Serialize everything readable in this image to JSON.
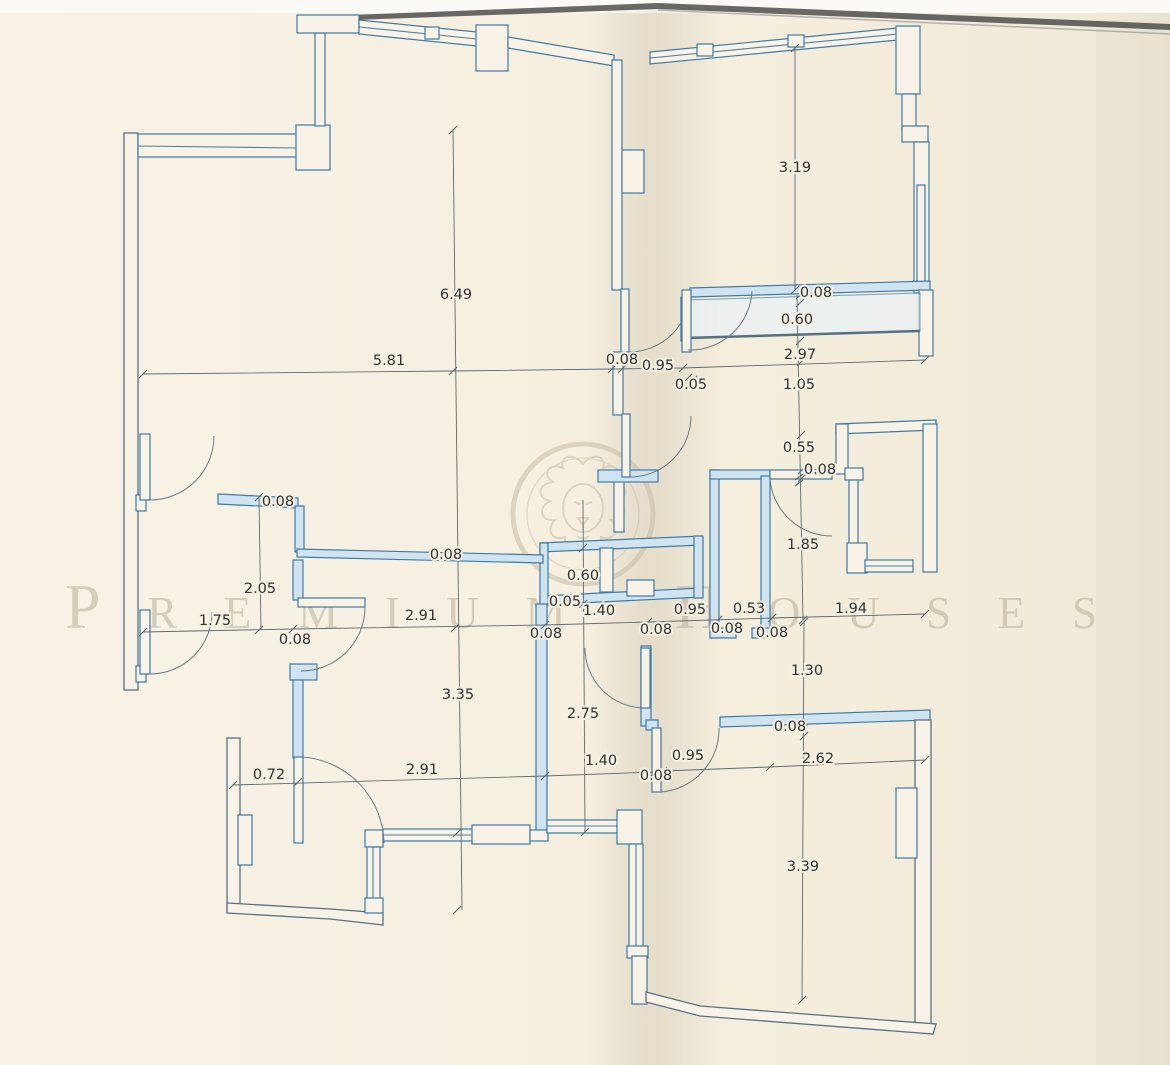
{
  "watermark": {
    "brand": "Premium Houses"
  },
  "plan": {
    "dimensions": [
      {
        "value": "3.19",
        "x": 795,
        "y": 172
      },
      {
        "value": "0.08",
        "x": 816,
        "y": 297
      },
      {
        "value": "0.60",
        "x": 797,
        "y": 324
      },
      {
        "value": "2.97",
        "x": 800,
        "y": 359
      },
      {
        "value": "0.08",
        "x": 622,
        "y": 364
      },
      {
        "value": "0.95",
        "x": 658,
        "y": 370
      },
      {
        "value": "0.05",
        "x": 691,
        "y": 389
      },
      {
        "value": "1.05",
        "x": 799,
        "y": 389
      },
      {
        "value": "0.55",
        "x": 799,
        "y": 452
      },
      {
        "value": "0.08",
        "x": 820,
        "y": 474
      },
      {
        "value": "1.85",
        "x": 803,
        "y": 549
      },
      {
        "value": "6.49",
        "x": 456,
        "y": 299
      },
      {
        "value": "5.81",
        "x": 389,
        "y": 365
      },
      {
        "value": "0.08",
        "x": 278,
        "y": 506
      },
      {
        "value": "0.08",
        "x": 446,
        "y": 559
      },
      {
        "value": "0.60",
        "x": 583,
        "y": 580
      },
      {
        "value": "0.05",
        "x": 565,
        "y": 606
      },
      {
        "value": "2.05",
        "x": 260,
        "y": 593
      },
      {
        "value": "1.75",
        "x": 215,
        "y": 625
      },
      {
        "value": "2.91",
        "x": 421,
        "y": 620
      },
      {
        "value": "1.40",
        "x": 599,
        "y": 615
      },
      {
        "value": "0.95",
        "x": 690,
        "y": 614
      },
      {
        "value": "0.53",
        "x": 749,
        "y": 613
      },
      {
        "value": "1.94",
        "x": 851,
        "y": 613
      },
      {
        "value": "0.08",
        "x": 295,
        "y": 644
      },
      {
        "value": "0.08",
        "x": 546,
        "y": 638
      },
      {
        "value": "0.08",
        "x": 656,
        "y": 634
      },
      {
        "value": "0.08",
        "x": 727,
        "y": 633
      },
      {
        "value": "0.08",
        "x": 772,
        "y": 637
      },
      {
        "value": "1.30",
        "x": 807,
        "y": 675
      },
      {
        "value": "3.35",
        "x": 458,
        "y": 699
      },
      {
        "value": "2.75",
        "x": 583,
        "y": 718
      },
      {
        "value": "0.08",
        "x": 790,
        "y": 731
      },
      {
        "value": "0.72",
        "x": 269,
        "y": 779
      },
      {
        "value": "2.91",
        "x": 422,
        "y": 774
      },
      {
        "value": "1.40",
        "x": 601,
        "y": 765
      },
      {
        "value": "0.08",
        "x": 656,
        "y": 780
      },
      {
        "value": "0.95",
        "x": 688,
        "y": 760
      },
      {
        "value": "2.62",
        "x": 818,
        "y": 763
      },
      {
        "value": "3.39",
        "x": 803,
        "y": 871
      }
    ]
  }
}
